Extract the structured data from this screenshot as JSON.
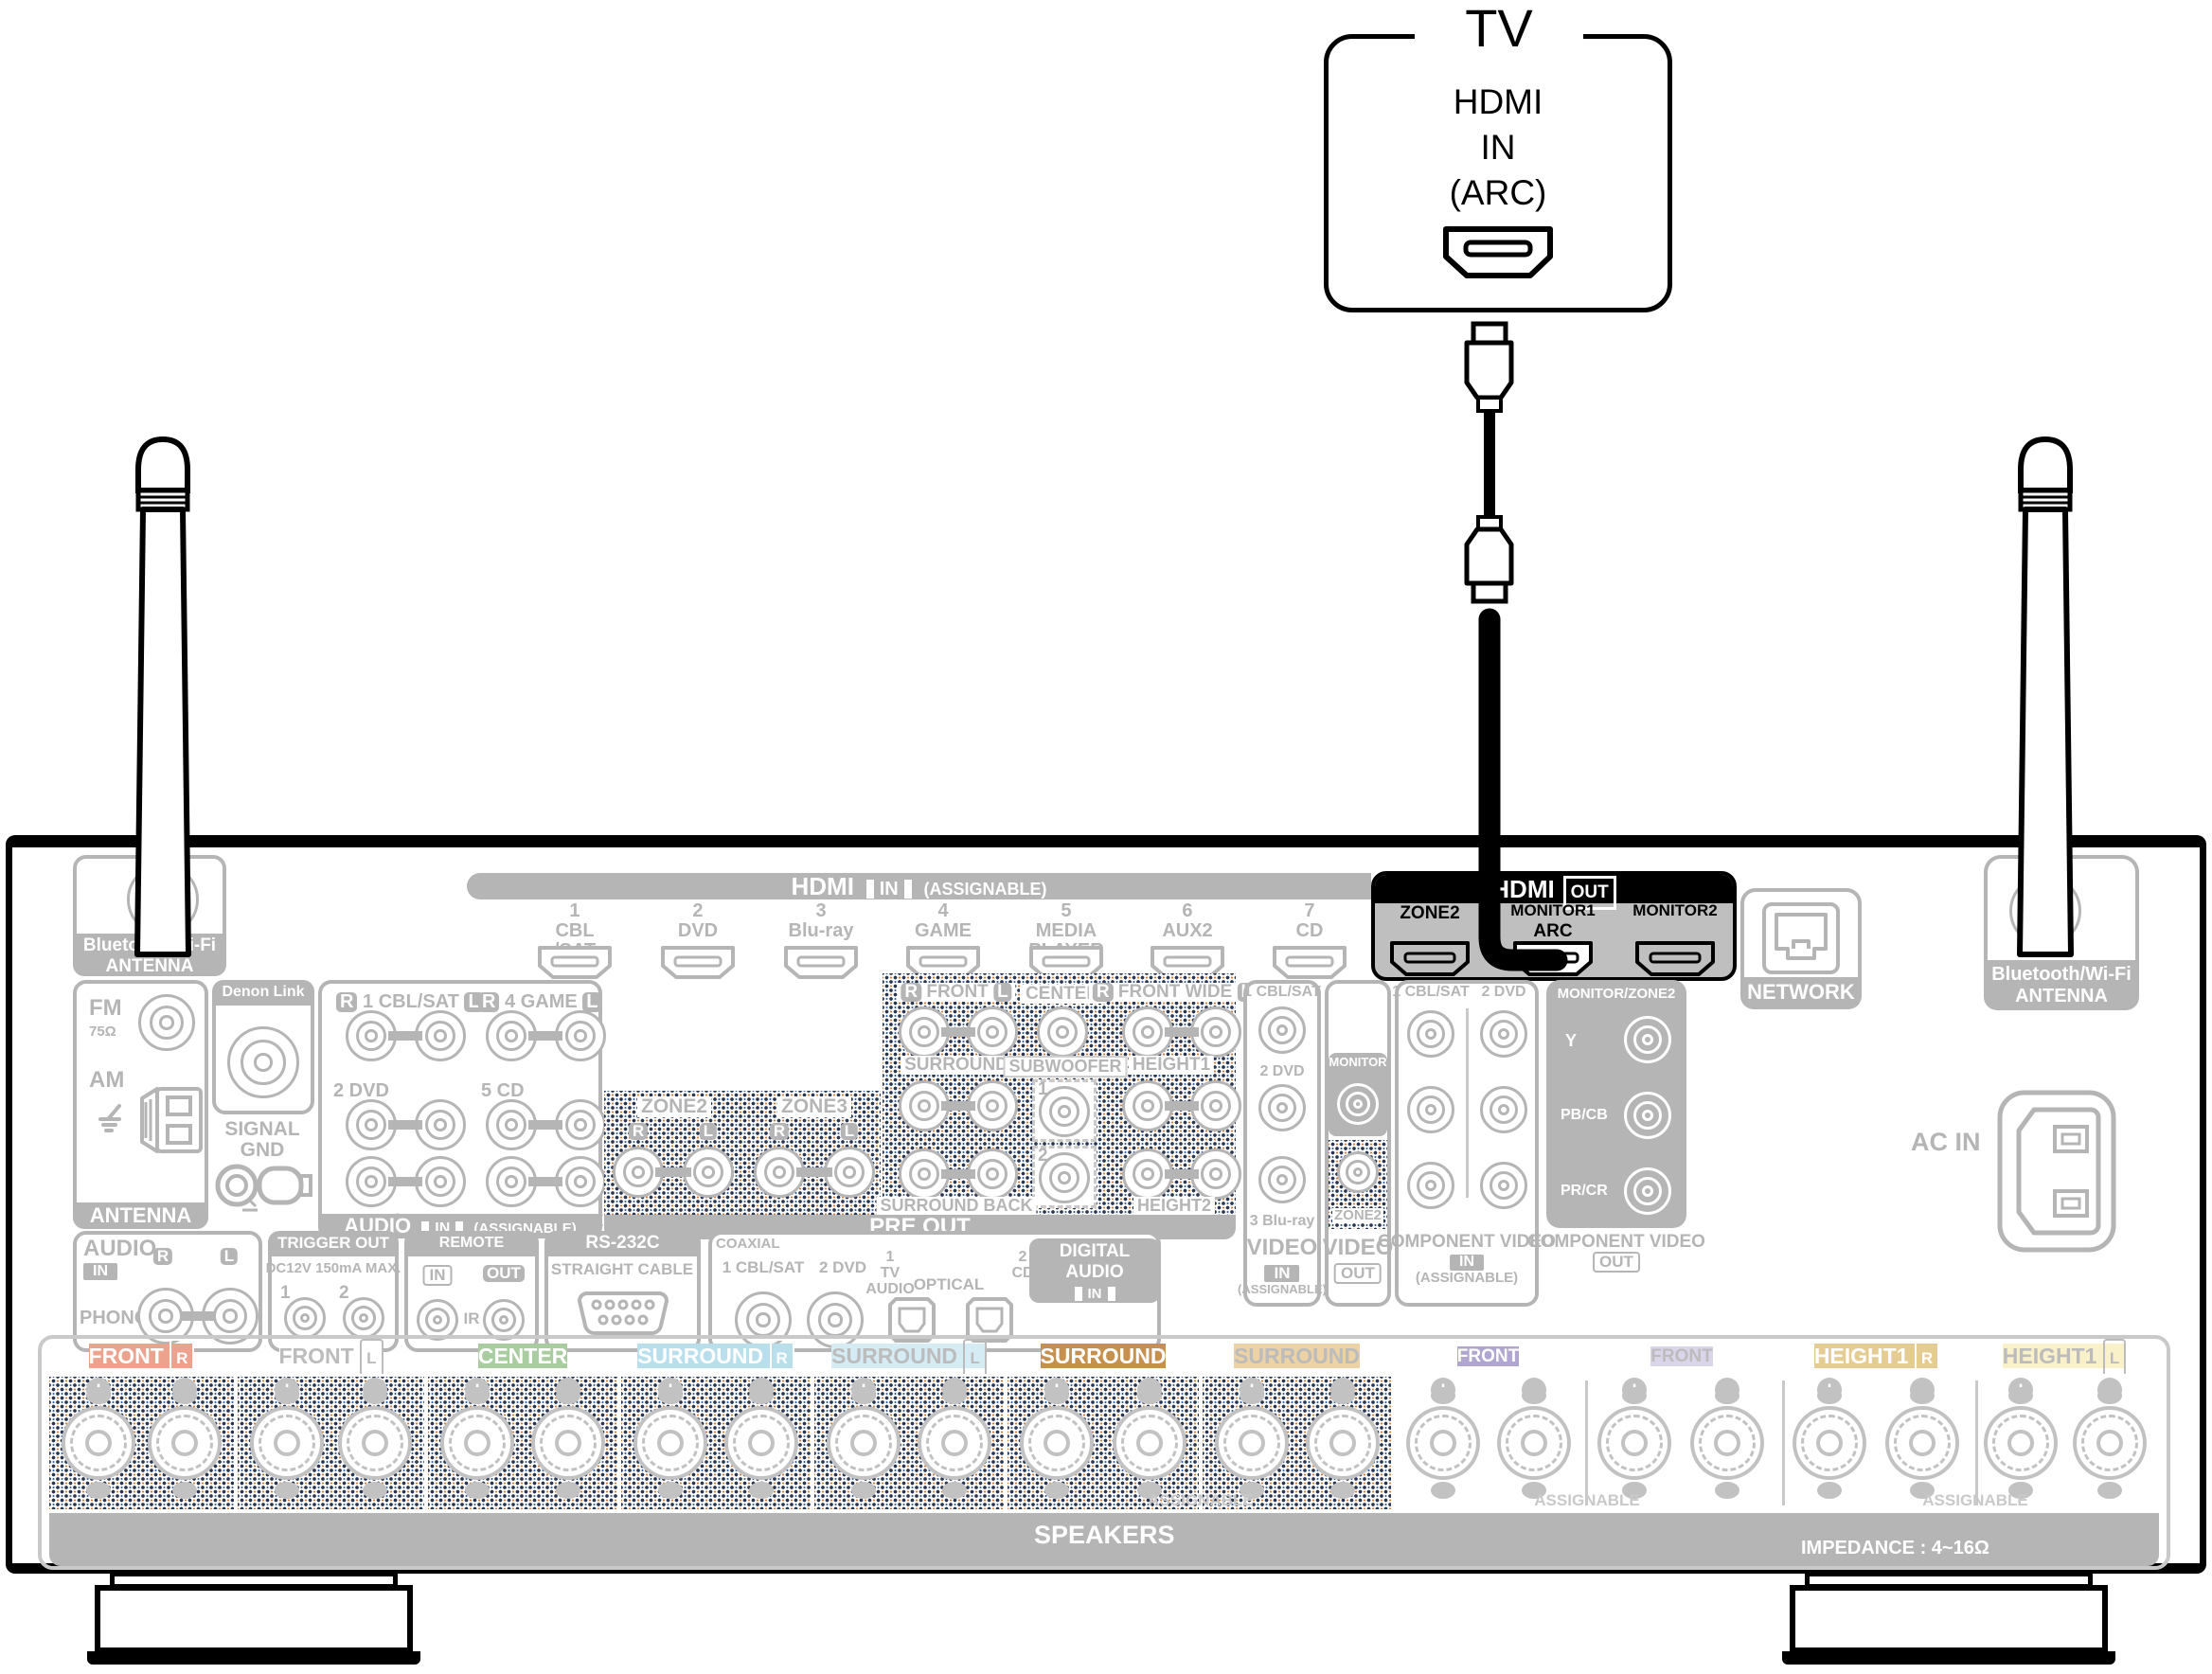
{
  "tv": {
    "title": "TV",
    "line1": "HDMI",
    "line2": "IN",
    "line3": "(ARC)"
  },
  "labels": {
    "r": "R",
    "l": "L",
    "in": "IN",
    "out": "OUT",
    "assignable": "(ASSIGNABLE)",
    "assignable_plain": "ASSIGNABLE"
  },
  "hdmi_in": {
    "title": "HDMI",
    "ports": [
      [
        "1",
        "CBL",
        "/SAT"
      ],
      [
        "2",
        "DVD",
        ""
      ],
      [
        "3",
        "Blu-ray",
        ""
      ],
      [
        "4",
        "GAME",
        ""
      ],
      [
        "5",
        "MEDIA",
        "PLAYER"
      ],
      [
        "6",
        "AUX2",
        ""
      ],
      [
        "7",
        "CD",
        ""
      ]
    ]
  },
  "hdmi_out": {
    "title": "HDMI",
    "zone2": "ZONE2",
    "monitor1": "MONITOR1",
    "arc": "ARC",
    "monitor2": "MONITOR2"
  },
  "bt": {
    "line1": "Bluetooth/Wi-Fi",
    "line2": "ANTENNA"
  },
  "tuner": {
    "fm": "FM",
    "ohm": "75Ω",
    "am": "AM",
    "footer": "ANTENNA"
  },
  "denon": {
    "title": "Denon Link HD",
    "gnd1": "SIGNAL",
    "gnd2": "GND"
  },
  "analog": {
    "p1": "1 CBL/SAT",
    "p2": "2 DVD",
    "p3": "3 Blu-ray",
    "p4": "4 GAME",
    "p5": "5 CD",
    "p6": "6 MEDIA PLAYER",
    "footer": "AUDIO"
  },
  "preout": {
    "zone2": "ZONE2",
    "zone3": "ZONE3",
    "front": "FRONT",
    "center": "CENTER",
    "frontwide": "FRONT WIDE",
    "surround": "SURROUND",
    "subwoofer": "SUBWOOFER",
    "n1": "1",
    "n2": "2",
    "height1": "HEIGHT1",
    "surroundback": "SURROUND BACK",
    "height2": "HEIGHT2",
    "footer": "PRE OUT"
  },
  "video_in": {
    "p1": "1 CBL/SAT",
    "p2": "2 DVD",
    "p3": "3 Blu-ray",
    "f": "VIDEO"
  },
  "video_out": {
    "monitor": "MONITOR",
    "zone2": "ZONE2",
    "f": "VIDEO"
  },
  "comp_in": {
    "p1": "1 CBL/SAT",
    "p2": "2 DVD",
    "f": "COMPONENT VIDEO"
  },
  "comp_out": {
    "title": "MONITOR/ZONE2",
    "y": "Y",
    "pb": "PB/CB",
    "pr": "PR/CR",
    "f": "COMPONENT VIDEO"
  },
  "network": {
    "label": "NETWORK"
  },
  "ac": {
    "label": "AC IN"
  },
  "phono": {
    "title": "AUDIO",
    "name": "PHONO"
  },
  "trigger": {
    "title": "TRIGGER OUT",
    "sub": "DC12V 150mA MAX.",
    "n1": "1",
    "n2": "2"
  },
  "remote": {
    "title": "REMOTE CONTROL",
    "ir": "IR"
  },
  "rs232": {
    "title": "RS-232C",
    "sub": "STRAIGHT CABLE"
  },
  "digital": {
    "coaxial": "COAXIAL",
    "p1": "1 CBL/SAT",
    "p2": "2 DVD",
    "tv_n": "1",
    "tv1": "TV",
    "tv2": "AUDIO",
    "optical": "OPTICAL",
    "cd_n": "2",
    "cd": "CD",
    "badge": "DIGITAL AUDIO"
  },
  "speakers": {
    "groups": [
      {
        "label": "FRONT",
        "badge": "R",
        "style": "background:#eda28d;color:#ffffff"
      },
      {
        "label": "FRONT",
        "badge": "L",
        "style": "background:#ffffff;color:#bcbcbc"
      },
      {
        "label": "CENTER",
        "badge": "",
        "style": "background:#a9cca1;color:#ffffff"
      },
      {
        "label": "SURROUND",
        "badge": "R",
        "style": "background:#b9dfec;color:#ffffff"
      },
      {
        "label": "SURROUND",
        "badge": "L",
        "style": "background:#d5ecf5;color:#bcbcbc"
      },
      {
        "label": "SURROUND BACK",
        "badge": "R",
        "style": "background:#c6914f;color:#ffffff"
      },
      {
        "label": "SURROUND BACK",
        "badge": "L",
        "style": "background:#ecd2a4;color:#bcbcbc"
      },
      {
        "label": "FRONT WIDE/HEIGHT2",
        "badge": "R",
        "style": "background:#b1a5d1;color:#ffffff"
      },
      {
        "label": "FRONT WIDE/HEIGHT2",
        "badge": "L",
        "style": "background:#dbd5ea;color:#bcbcbc"
      },
      {
        "label": "HEIGHT1",
        "badge": "R",
        "style": "background:#e5cc92;color:#ffffff"
      },
      {
        "label": "HEIGHT1",
        "badge": "L",
        "style": "background:#f8f1c9;color:#bcbcbc"
      }
    ],
    "footer": "SPEAKERS",
    "impedance": "IMPEDANCE : 4~16Ω"
  },
  "colors": {
    "gray": "#b5b5b5",
    "highlight_black": "#000000",
    "monitor1_port": "#ffffff",
    "hdmi_out_body": "#bfbfbf"
  }
}
